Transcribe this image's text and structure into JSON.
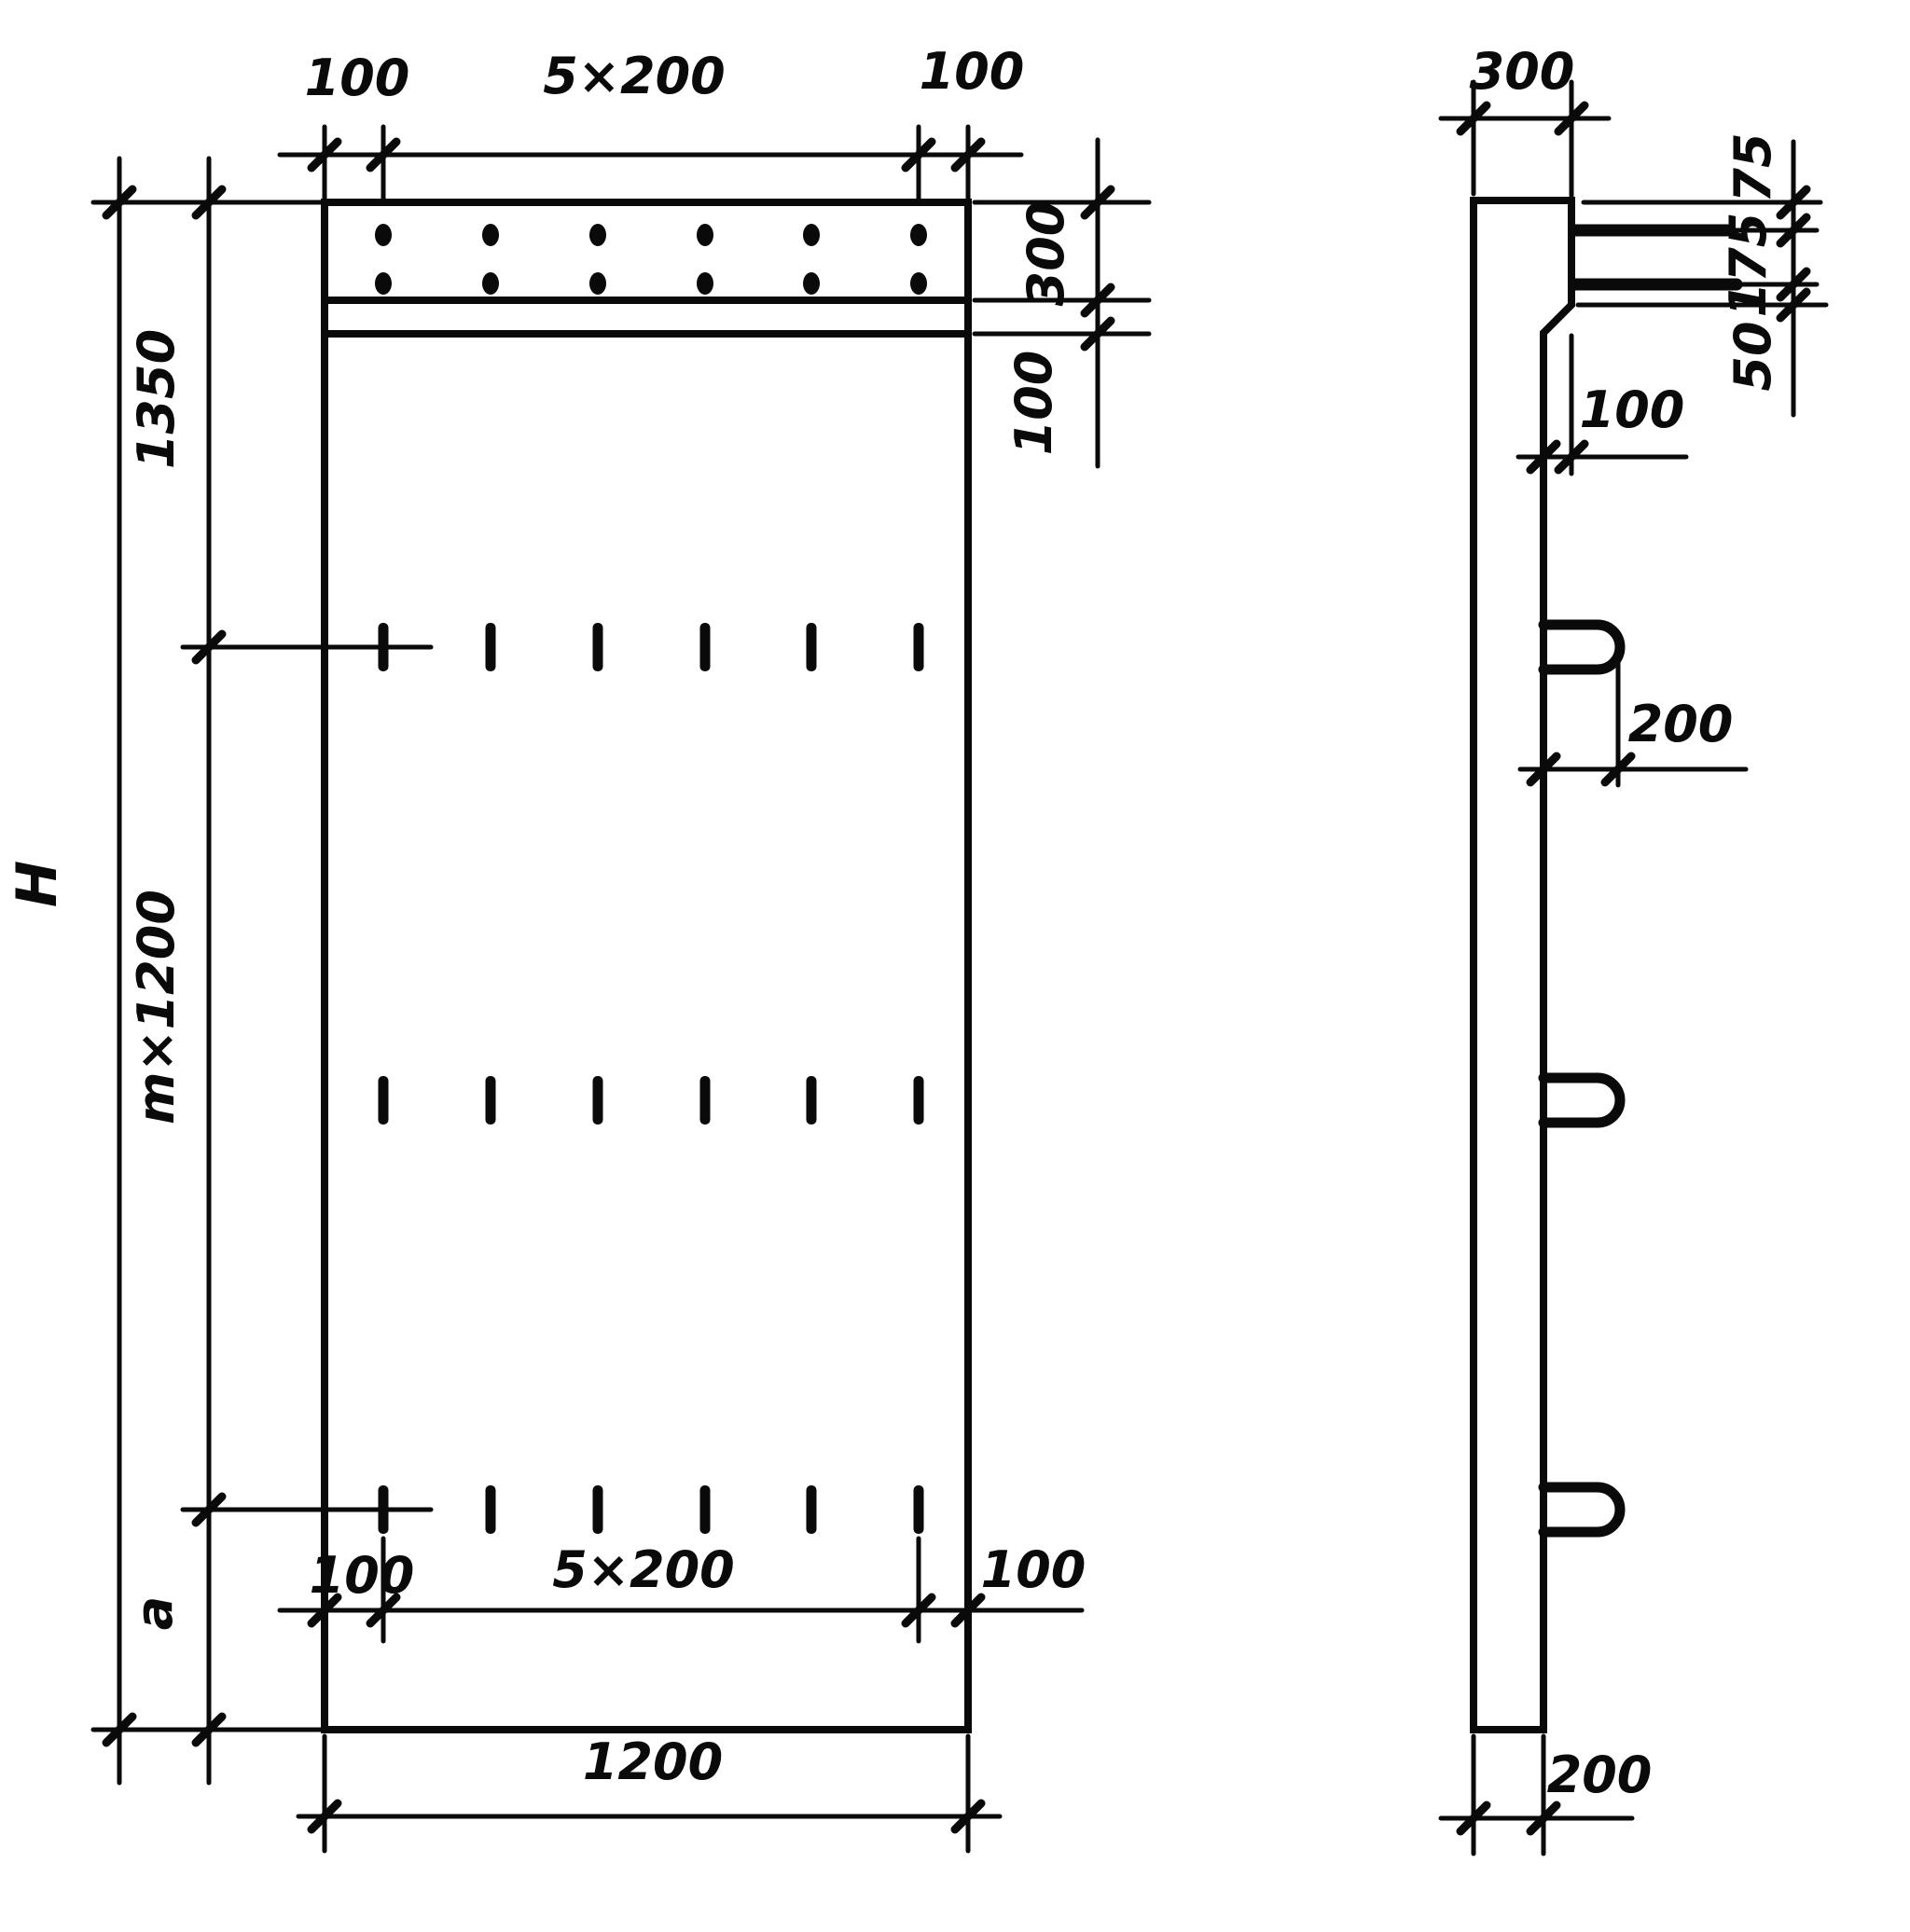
{
  "drawing": {
    "type": "engineering-drawing",
    "views": [
      "front",
      "side"
    ],
    "front_view": {
      "top_dimension": {
        "left_offset": "100",
        "spacing": "5×200",
        "right_offset": "100"
      },
      "right_dimension": {
        "band_height": "300",
        "ledge_gap": "100"
      },
      "left_dimension": {
        "overall_height": "H",
        "top_segment": "1350",
        "middle_segment": "m×1200",
        "bottom_segment": "a"
      },
      "bottom_dimension": {
        "left_offset": "100",
        "spacing": "5×200",
        "right_offset": "100",
        "overall_width": "1200"
      }
    },
    "side_view": {
      "top_thickness": "300",
      "bar_offsets": {
        "top": "75",
        "middle": "175",
        "bottom": "50"
      },
      "ledge_width": "100",
      "loop_length": "200",
      "body_thickness": "200"
    }
  }
}
